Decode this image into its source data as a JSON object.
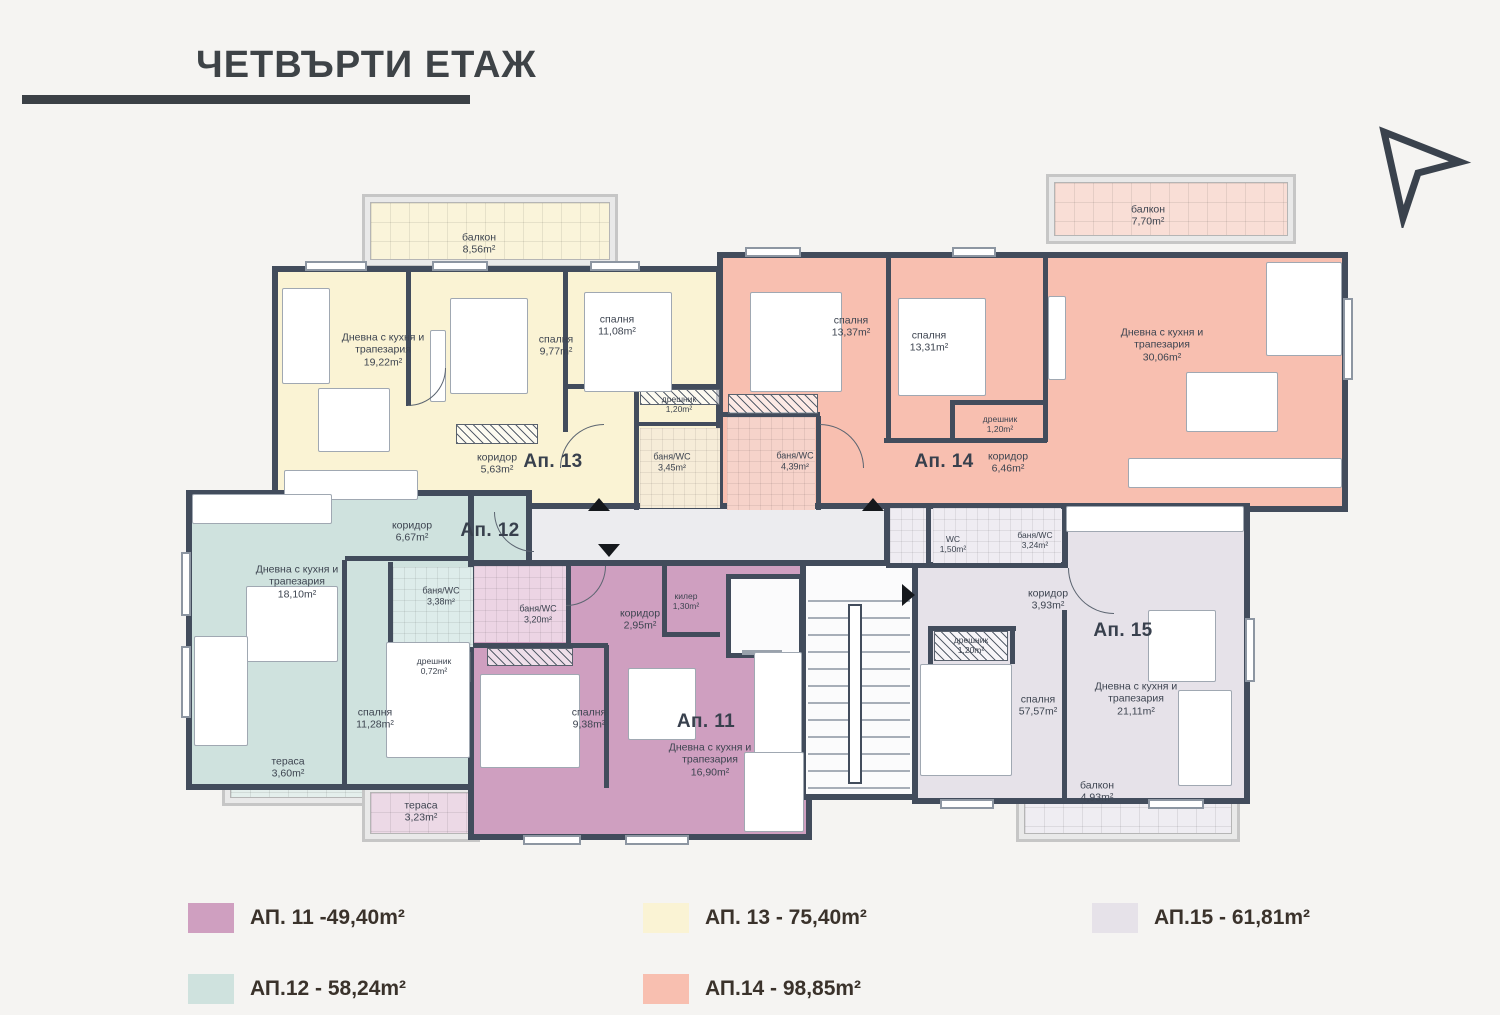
{
  "title": "ЧЕТВЪРТИ ЕТАЖ",
  "apartments": [
    {
      "id": "11",
      "label": "Ап. 11",
      "rooms": [
        {
          "name": "баня/WC",
          "area": "3,20m²"
        },
        {
          "name": "коридор",
          "area": "2,95m²"
        },
        {
          "name": "килер",
          "area": "1,30m²"
        },
        {
          "name": "спалня",
          "area": "9,38m²"
        },
        {
          "name": "Дневна с кухня и трапезария",
          "area": "16,90m²"
        },
        {
          "name": "тераса",
          "area": "3,23m²"
        }
      ]
    },
    {
      "id": "12",
      "label": "Ап. 12",
      "rooms": [
        {
          "name": "Дневна с кухня и трапезария",
          "area": "18,10m²"
        },
        {
          "name": "коридор",
          "area": "6,67m²"
        },
        {
          "name": "баня/WC",
          "area": "3,38m²"
        },
        {
          "name": "дрешник",
          "area": "0,72m²"
        },
        {
          "name": "спалня",
          "area": "11,28m²"
        },
        {
          "name": "тераса",
          "area": "3,60m²"
        }
      ]
    },
    {
      "id": "13",
      "label": "Ап. 13",
      "rooms": [
        {
          "name": "Дневна с кухня и трапезария",
          "area": "19,22m²"
        },
        {
          "name": "спалня",
          "area": "9,77m²"
        },
        {
          "name": "спалня",
          "area": "11,08m²"
        },
        {
          "name": "дрешник",
          "area": "1,20m²"
        },
        {
          "name": "коридор",
          "area": "5,63m²"
        },
        {
          "name": "баня/WC",
          "area": "3,45m²"
        },
        {
          "name": "балкон",
          "area": "8,56m²"
        }
      ]
    },
    {
      "id": "14",
      "label": "Ап. 14",
      "rooms": [
        {
          "name": "спалня",
          "area": "13,37m²"
        },
        {
          "name": "спалня",
          "area": "13,31m²"
        },
        {
          "name": "дрешник",
          "area": "1,20m²"
        },
        {
          "name": "баня/WC",
          "area": "4,39m²"
        },
        {
          "name": "коридор",
          "area": "6,46m²"
        },
        {
          "name": "Дневна с кухня и трапезария",
          "area": "30,06m²"
        },
        {
          "name": "балкон",
          "area": "7,70m²"
        }
      ]
    },
    {
      "id": "15",
      "label": "Ап. 15",
      "rooms": [
        {
          "name": "коридор",
          "area": "3,93m²"
        },
        {
          "name": "дрешник",
          "area": "1,20m²"
        },
        {
          "name": "спалня",
          "area": "57,57m²"
        },
        {
          "name": "Дневна с кухня и трапезария",
          "area": "21,11m²"
        },
        {
          "name": "балкон",
          "area": "4,93m²"
        }
      ]
    }
  ],
  "common": {
    "rooms": [
      {
        "name": "WC",
        "area": "1,50m²"
      },
      {
        "name": "баня/WC",
        "area": "3,24m²"
      }
    ]
  },
  "legend": [
    {
      "label": "АП. 11 -49,40m²",
      "color": "#cf9fc0"
    },
    {
      "label": "АП.12 - 58,24m²",
      "color": "#cfe2de"
    },
    {
      "label": "АП. 13 - 75,40m²",
      "color": "#faf3d4"
    },
    {
      "label": "АП.14 - 98,85m²",
      "color": "#f8bfb0"
    },
    {
      "label": "АП.15 - 61,81m²",
      "color": "#e6e2e9"
    }
  ],
  "colors": {
    "wall": "#424c5c",
    "common_area": "#ececef",
    "background": "#f5f4f2"
  }
}
